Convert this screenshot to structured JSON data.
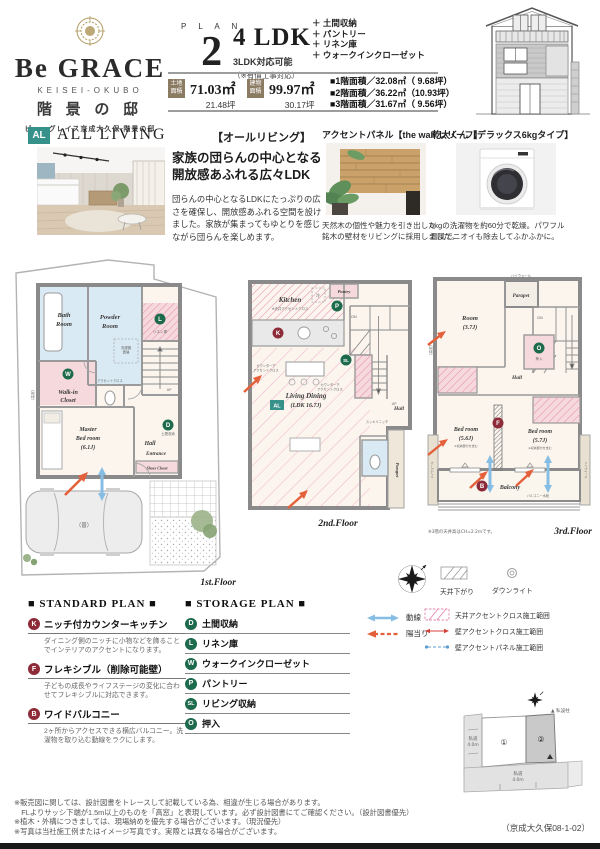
{
  "colors": {
    "accent_teal": "#37918b",
    "badge_red": "#8e2b38",
    "badge_green": "#1e6a4d",
    "gold": "#b1995f",
    "area_badge_brown": "#8c7b63",
    "plan_pink": "#f6d9dd",
    "plan_blue": "#daeaf4",
    "hatch_pink": "#e687ae",
    "arrow_blue": "#85bde4",
    "arrow_orange": "#e4603a"
  },
  "header": {
    "brand": "Be GRACE",
    "brand_sub": "KEISEI-OKUBO",
    "estate_name": "階 景 の 邸",
    "tagline": "ビー・グレイス京成大久保 階景の邸",
    "plan_label": "P L A N",
    "plan_number": "2",
    "ldk": "4 LDK",
    "ldk_sub": "3LDK対応可能",
    "ldk_note": "（※有償工事対応）",
    "feature_1": "＋ 土間収納",
    "feature_2": "＋ パントリー",
    "feature_3": "＋ リネン庫",
    "feature_4": "＋ ウォークインクローゼット",
    "land_badge_l1": "土地",
    "land_badge_l2": "面積",
    "land_sqm": "71.03㎡",
    "land_tsubo": "21.48坪",
    "bldg_badge_l1": "建物",
    "bldg_badge_l2": "面積",
    "bldg_sqm": "99.97㎡",
    "bldg_tsubo": "30.17坪",
    "floor_area_1": "■1階面積／32.08㎡（ 9.68坪）",
    "floor_area_2": "■2階面積／36.22㎡（10.93坪）",
    "floor_area_3": "■3階面積／31.67㎡（ 9.56坪）"
  },
  "all_living": {
    "badge": "AL",
    "title_en": "ALL LIVING",
    "title_jp": "【オールリビング】",
    "headline_1": "家族の団らんの中心となる",
    "headline_2": "開放感あふれる広々LDK",
    "body": "団らんの中心となるLDKにたっぷりの広さを確保し、開放感あふれる空間を設けました。家族が集まってもゆとりを感じながら団らんを楽しめます。"
  },
  "panel_card": {
    "title": "アクセントパネル【the wall レリーフ】",
    "caption_1": "天然木の個性や魅力を引き出した",
    "caption_2": "銘木の壁材をリビングに採用しました。"
  },
  "dryer_card": {
    "title": "乾太くん【デラックス6kgタイプ】",
    "caption_1": "6kgの洗濯物を約60分で乾燥。パワフル",
    "caption_2": "温風でニオイも除去してふかふかに。"
  },
  "floor1": {
    "label": "1st.Floor",
    "bath_1": "Bath",
    "bath_2": "Room",
    "powder_1": "Powder",
    "powder_2": "Room",
    "washer_1": "洗濯機",
    "washer_2": "置場",
    "linen_badge": "L",
    "linen": "リネン庫",
    "wic_badge": "W",
    "wic_1": "Walk-in",
    "wic_2": "Closet",
    "accent_note": "アクセントクロス",
    "hall": "Hall",
    "master_1": "Master",
    "master_2": "Bed room",
    "master_3": "(6.1J)",
    "entrance": "Entrance",
    "shoes": "Shoes Closet",
    "doma_badge": "D",
    "doma": "土間収納",
    "up": "UP",
    "car": "（普）",
    "takamado": "〈高窓〉"
  },
  "floor2": {
    "label": "2nd.Floor",
    "kitchen": "Kitchen",
    "kitchen_note": "※天井アクセントクロス",
    "kitchen_badge": "K",
    "fridge": "冷",
    "pantry": "Pantry",
    "pantry_badge": "P",
    "sl_badge": "SL",
    "dn": "DN",
    "up": "UP",
    "counter_note_1": "カウンター下",
    "counter_note_2": "アクセントクロス",
    "al_badge": "AL",
    "living_1": "Living Dining",
    "living_2": "(LDK 16.7J)",
    "hall": "Hall",
    "niche": "スッキリニッチ",
    "parapet": "Parapet"
  },
  "floor3": {
    "label": "3rd.Floor",
    "highwall": "ハイウォール",
    "parapet": "Parapet",
    "room_1": "Room",
    "room_2": "(3.7J)",
    "dn": "DN",
    "hall": "Hall",
    "oshiire_badge": "O",
    "oshiire": "押入",
    "bed1_1": "Bed room",
    "bed1_2": "(5.6J)",
    "bed2_1": "Bed room",
    "bed2_2": "(5.7J)",
    "bed_note": "※収納部分を含む",
    "f_badge": "F",
    "b_badge": "B",
    "balcony": "Balcony",
    "tap": "バルコニー水栓",
    "note": "※3階の天井高はCH=2.2mです。",
    "takamado": "〈高窓〉"
  },
  "legend": {
    "ceiling_drop": "天井下がり",
    "downlight": "ダウンライト",
    "flow": "動線",
    "sun": "陽当り",
    "ceiling_accent": "天井アクセントクロス施工範囲",
    "wall_cloth": "壁アクセントクロス施工範囲",
    "wall_panel": "壁アクセントパネル施工範囲"
  },
  "standard_plan": {
    "title": "■ STANDARD PLAN ■",
    "items": [
      {
        "badge": "K",
        "title": "ニッチ付カウンターキッチン",
        "desc": "ダイニング側のニッチに小物などを飾ることでインテリアのアクセントになります。"
      },
      {
        "badge": "F",
        "title": "フレキシブル（削除可能壁）",
        "desc": "子どもの成長やライフステージの変化に合わせてフレキシブルに対応できます。"
      },
      {
        "badge": "B",
        "title": "ワイドバルコニー",
        "desc": "2ヶ所からアクセスできる横広バルコニー。洗濯物を取り込む動線をラクにします。"
      }
    ]
  },
  "storage_plan": {
    "title": "■ STORAGE PLAN ■",
    "items": [
      {
        "badge": "D",
        "label": "土間収納"
      },
      {
        "badge": "L",
        "label": "リネン庫"
      },
      {
        "badge": "W",
        "label": "ウォークインクローゼット"
      },
      {
        "badge": "P",
        "label": "パントリー"
      },
      {
        "badge": "SL",
        "label": "リビング収納"
      },
      {
        "badge": "O",
        "label": "押入"
      }
    ]
  },
  "site_plan": {
    "lot1": "①",
    "lot2": "②",
    "road_left_1": "私道",
    "road_left_2": "4.0m",
    "road_bottom_1": "私道",
    "road_bottom_2": "4.0m",
    "pole": "▲ 私設柱"
  },
  "disclaimer": {
    "line1": "※販売図に関しては、設計図書をトレースして記載している為、相違が生じる場合があります。",
    "line2": "　FLよりサッシ下端が1.5m以上のものを「高窓」と表現しています。必ず設計図書にてご確認ください。（設計図書優先）",
    "line3": "※植木・外構につきましては、現場納めを優先する場合がございます。（現況優先）",
    "line4": "※写真は当社施工例またはイメージ写真です。実際とは異なる場合がございます。"
  },
  "footer_code": "（京成大久保08-1-02）"
}
